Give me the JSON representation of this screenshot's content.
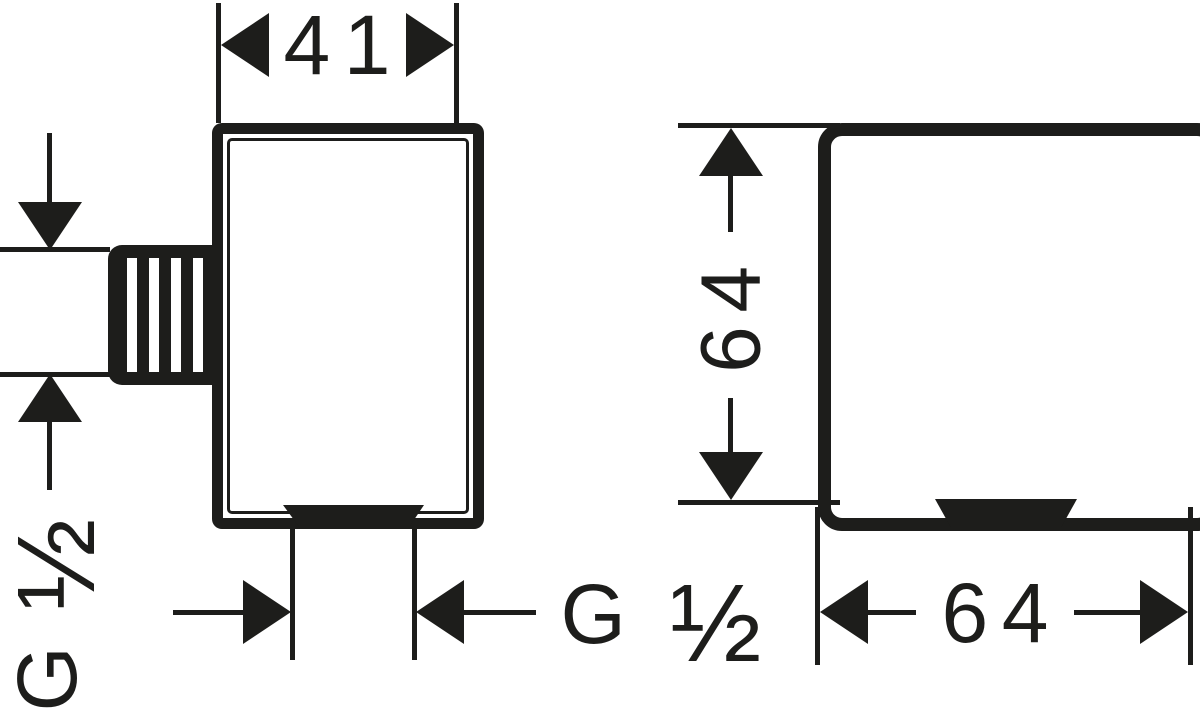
{
  "colors": {
    "ink": "#1d1d1b",
    "paper": "#ffffff"
  },
  "side_view": {
    "width_dim_label": "41",
    "thread_size": {
      "prefix": "G",
      "fraction": "½"
    },
    "outlet_size": {
      "prefix": "G",
      "fraction": "½"
    }
  },
  "front_view": {
    "height_dim_label": "64",
    "width_dim_label": "64"
  }
}
